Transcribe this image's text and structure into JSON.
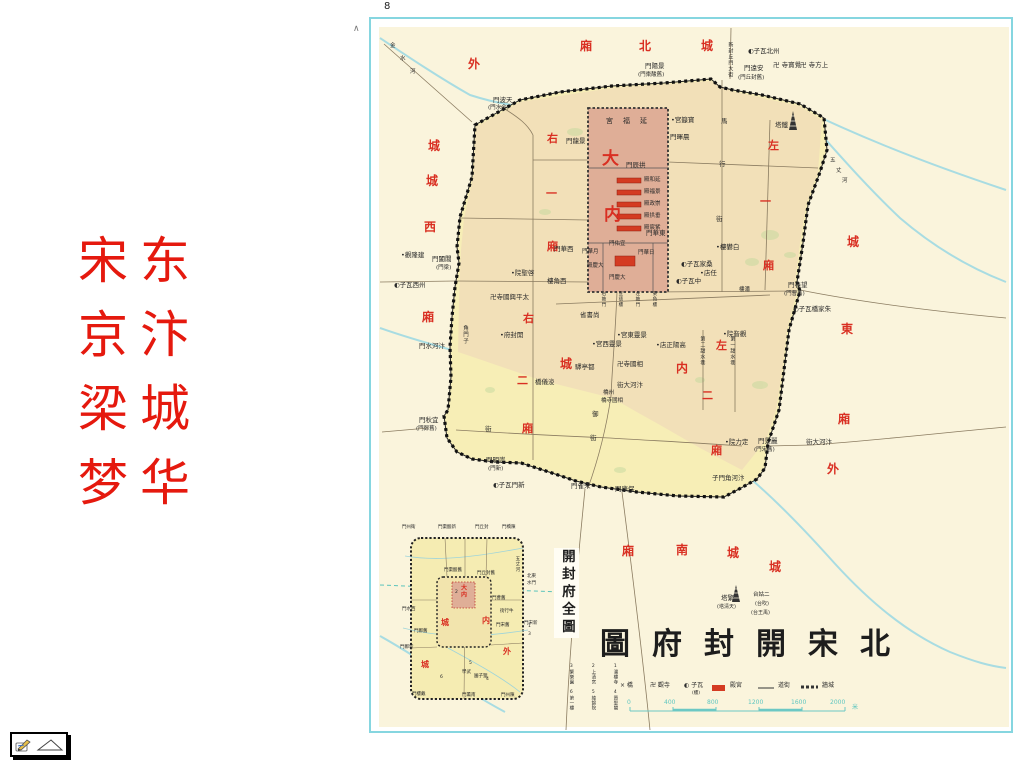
{
  "page": {
    "number": "8",
    "caret": "∧"
  },
  "slide_title": {
    "rows": [
      "宋东",
      "京汴",
      "梁城",
      "梦华"
    ],
    "color": "#e5190e"
  },
  "colors": {
    "slide_title_red": "#e5190e",
    "map_label_red": "#d92f22",
    "outer_paper": "#faf4dc",
    "city_fill": "#f7eeb6",
    "north_tint": "#f2e0b8",
    "palace_fill": "#dfae97",
    "hall_red": "#d43b22",
    "river_cyan": "#a8dce2",
    "frame_cyan": "#86d6e0",
    "scale_teal": "#5fc6c0"
  },
  "map": {
    "title": "圖府封開宋北",
    "inset_title": "開封府全圖",
    "legend": {
      "items": [
        {
          "sym": "×",
          "label": "橋",
          "x": 620
        },
        {
          "sym": "卍",
          "label": "觀寺",
          "x": 650
        },
        {
          "sym": "◐",
          "label": "子瓦",
          "x": 684,
          "sub": "(樓)"
        },
        {
          "sym": "rect",
          "label": "殿宮",
          "x": 730
        },
        {
          "sym": "line",
          "label": "道街",
          "x": 778
        },
        {
          "sym": "dash",
          "label": "牆城",
          "x": 822
        }
      ],
      "y": 683
    },
    "scale": {
      "ticks": [
        "0",
        "400",
        "800",
        "1200",
        "1600",
        "2000"
      ],
      "tick_x": [
        627,
        664,
        707,
        748,
        791,
        830
      ],
      "unit": "米",
      "unit_x": 852,
      "y": 700
    },
    "inset_legend": {
      "items": [
        "1潘樓寺",
        "2上清宮",
        "3繁樂園",
        "4資聖閣",
        "5綾錦院",
        "6第一樓"
      ],
      "col_x": [
        612,
        590,
        568
      ],
      "row_y": [
        664,
        690
      ]
    },
    "labels": [
      {
        "t": "外",
        "x": 468,
        "y": 58,
        "c": "red",
        "s": 12
      },
      {
        "t": "城",
        "x": 428,
        "y": 140,
        "c": "red",
        "s": 12
      },
      {
        "t": "城",
        "x": 426,
        "y": 175,
        "c": "red",
        "s": 12
      },
      {
        "t": "西",
        "x": 424,
        "y": 221,
        "c": "red",
        "s": 12
      },
      {
        "t": "廂",
        "x": 422,
        "y": 311,
        "c": "red",
        "s": 12
      },
      {
        "t": "廂",
        "x": 580,
        "y": 40,
        "c": "red",
        "s": 12
      },
      {
        "t": "北",
        "x": 639,
        "y": 40,
        "c": "red",
        "s": 12
      },
      {
        "t": "城",
        "x": 701,
        "y": 40,
        "c": "red",
        "s": 12
      },
      {
        "t": "右",
        "x": 547,
        "y": 133,
        "c": "red",
        "s": 11
      },
      {
        "t": "一",
        "x": 546,
        "y": 188,
        "c": "red",
        "s": 11
      },
      {
        "t": "廂",
        "x": 547,
        "y": 241,
        "c": "red",
        "s": 11
      },
      {
        "t": "左",
        "x": 768,
        "y": 140,
        "c": "red",
        "s": 11
      },
      {
        "t": "一",
        "x": 760,
        "y": 196,
        "c": "red",
        "s": 11
      },
      {
        "t": "廂",
        "x": 763,
        "y": 260,
        "c": "red",
        "s": 11
      },
      {
        "t": "大",
        "x": 602,
        "y": 150,
        "c": "red",
        "s": 17
      },
      {
        "t": "内",
        "x": 604,
        "y": 206,
        "c": "red",
        "s": 17
      },
      {
        "t": "右",
        "x": 523,
        "y": 313,
        "c": "red",
        "s": 11
      },
      {
        "t": "二",
        "x": 517,
        "y": 375,
        "c": "red",
        "s": 11
      },
      {
        "t": "廂",
        "x": 522,
        "y": 423,
        "c": "red",
        "s": 11
      },
      {
        "t": "内",
        "x": 676,
        "y": 362,
        "c": "red",
        "s": 12
      },
      {
        "t": "城",
        "x": 560,
        "y": 358,
        "c": "red",
        "s": 12
      },
      {
        "t": "左",
        "x": 716,
        "y": 340,
        "c": "red",
        "s": 11
      },
      {
        "t": "二",
        "x": 702,
        "y": 390,
        "c": "red",
        "s": 11
      },
      {
        "t": "廂",
        "x": 711,
        "y": 445,
        "c": "red",
        "s": 11
      },
      {
        "t": "城",
        "x": 847,
        "y": 236,
        "c": "red",
        "s": 12
      },
      {
        "t": "東",
        "x": 841,
        "y": 323,
        "c": "red",
        "s": 12
      },
      {
        "t": "廂",
        "x": 838,
        "y": 413,
        "c": "red",
        "s": 12
      },
      {
        "t": "外",
        "x": 827,
        "y": 463,
        "c": "red",
        "s": 12
      },
      {
        "t": "廂",
        "x": 622,
        "y": 545,
        "c": "red",
        "s": 12
      },
      {
        "t": "南",
        "x": 676,
        "y": 544,
        "c": "red",
        "s": 12
      },
      {
        "t": "城",
        "x": 727,
        "y": 547,
        "c": "red",
        "s": 12
      },
      {
        "t": "城",
        "x": 769,
        "y": 561,
        "c": "red",
        "s": 12
      },
      {
        "t": "門波天",
        "x": 493,
        "y": 97
      },
      {
        "t": "(門水金)",
        "x": 488,
        "y": 106,
        "s": 5.5
      },
      {
        "t": "門陽景",
        "x": 645,
        "y": 63
      },
      {
        "t": "(門棗酸舊)",
        "x": 638,
        "y": 73,
        "s": 5.5
      },
      {
        "t": "門遠安",
        "x": 744,
        "y": 65
      },
      {
        "t": "(門丘封舊)",
        "x": 738,
        "y": 76,
        "s": 5.5
      },
      {
        "t": "◐子瓦北州",
        "x": 748,
        "y": 48
      },
      {
        "t": "卍 寺寶覺",
        "x": 773,
        "y": 62
      },
      {
        "t": "卍 寺方上",
        "x": 800,
        "y": 62
      },
      {
        "t": "新封丘門大街",
        "x": 727,
        "y": 42,
        "v": 1,
        "s": 5
      },
      {
        "t": "塔鐵",
        "x": 775,
        "y": 122
      },
      {
        "t": "金",
        "x": 390,
        "y": 44,
        "s": 5.5
      },
      {
        "t": "水",
        "x": 400,
        "y": 57,
        "s": 5.5
      },
      {
        "t": "河",
        "x": 410,
        "y": 70,
        "s": 5.5
      },
      {
        "t": "五",
        "x": 830,
        "y": 159,
        "s": 5.5
      },
      {
        "t": "丈",
        "x": 836,
        "y": 169,
        "s": 5.5
      },
      {
        "t": "河",
        "x": 842,
        "y": 179,
        "s": 5.5
      },
      {
        "t": "宮福延",
        "x": 606,
        "y": 118,
        "s": 7,
        "ls": 10
      },
      {
        "t": "門龍景",
        "x": 566,
        "y": 138
      },
      {
        "t": "•宮籙寶",
        "x": 671,
        "y": 117
      },
      {
        "t": "門暉晨",
        "x": 670,
        "y": 134
      },
      {
        "t": "門辰拱",
        "x": 626,
        "y": 162
      },
      {
        "t": "殿和延",
        "x": 644,
        "y": 178,
        "s": 5.5
      },
      {
        "t": "殿福景",
        "x": 644,
        "y": 190,
        "s": 5.5
      },
      {
        "t": "殿政崇",
        "x": 644,
        "y": 202,
        "s": 5.5
      },
      {
        "t": "殿拱垂",
        "x": 644,
        "y": 214,
        "s": 5.5
      },
      {
        "t": "殿宸紫",
        "x": 644,
        "y": 226,
        "s": 5.5
      },
      {
        "t": "門華東",
        "x": 646,
        "y": 230
      },
      {
        "t": "門華西",
        "x": 554,
        "y": 246
      },
      {
        "t": "門佑宜",
        "x": 609,
        "y": 242,
        "s": 5.5
      },
      {
        "t": "門華月",
        "x": 582,
        "y": 250,
        "s": 5.5
      },
      {
        "t": "門華日",
        "x": 638,
        "y": 251,
        "s": 5.5
      },
      {
        "t": "殿慶大",
        "x": 587,
        "y": 264,
        "s": 5.5
      },
      {
        "t": "門慶大",
        "x": 609,
        "y": 276,
        "s": 5.5
      },
      {
        "t": "樓角西",
        "x": 547,
        "y": 278
      },
      {
        "t": "右掖門",
        "x": 600,
        "y": 291,
        "v": 1,
        "s": 4.5
      },
      {
        "t": "宣德樓",
        "x": 617,
        "y": 291,
        "v": 1,
        "s": 4.5
      },
      {
        "t": "左掖門",
        "x": 634,
        "y": 291,
        "v": 1,
        "s": 4.5
      },
      {
        "t": "東角樓",
        "x": 651,
        "y": 291,
        "v": 1,
        "s": 4.5
      },
      {
        "t": "•觀隆建",
        "x": 401,
        "y": 252
      },
      {
        "t": "門闔閶",
        "x": 432,
        "y": 256
      },
      {
        "t": "(門梁)",
        "x": 436,
        "y": 266,
        "s": 5.5
      },
      {
        "t": "◐子瓦西州",
        "x": 394,
        "y": 282
      },
      {
        "t": "•院聖啓",
        "x": 511,
        "y": 270
      },
      {
        "t": "卍寺國興平太",
        "x": 490,
        "y": 294
      },
      {
        "t": "角門子",
        "x": 461,
        "y": 325,
        "v": 1,
        "s": 5.5
      },
      {
        "t": "門水河汴",
        "x": 419,
        "y": 343
      },
      {
        "t": "門秋宜",
        "x": 419,
        "y": 417
      },
      {
        "t": "(門鄭舊)",
        "x": 416,
        "y": 427,
        "s": 5.5
      },
      {
        "t": "街",
        "x": 485,
        "y": 426
      },
      {
        "t": "門明崇",
        "x": 486,
        "y": 457
      },
      {
        "t": "(門新)",
        "x": 488,
        "y": 467,
        "s": 5.5
      },
      {
        "t": "◐子瓦門新",
        "x": 493,
        "y": 482
      },
      {
        "t": "門雀朱",
        "x": 571,
        "y": 483
      },
      {
        "t": "門康保",
        "x": 615,
        "y": 486
      },
      {
        "t": "子門角河汴",
        "x": 712,
        "y": 475
      },
      {
        "t": "•府封開",
        "x": 500,
        "y": 332
      },
      {
        "t": "省書尚",
        "x": 580,
        "y": 312
      },
      {
        "t": "•宮西靈景",
        "x": 592,
        "y": 341
      },
      {
        "t": "•宮東靈景",
        "x": 617,
        "y": 332
      },
      {
        "t": "驛亭都",
        "x": 575,
        "y": 364
      },
      {
        "t": "卍寺國相",
        "x": 617,
        "y": 361
      },
      {
        "t": "橋儀浚",
        "x": 535,
        "y": 379
      },
      {
        "t": "橋州",
        "x": 603,
        "y": 391,
        "s": 5.5
      },
      {
        "t": "橋寺國相",
        "x": 601,
        "y": 399,
        "s": 5.5
      },
      {
        "t": "街大河汴",
        "x": 617,
        "y": 382
      },
      {
        "t": "御",
        "x": 592,
        "y": 411
      },
      {
        "t": "街",
        "x": 590,
        "y": 435
      },
      {
        "t": "•店正陽高",
        "x": 656,
        "y": 342
      },
      {
        "t": "第二甜水巷",
        "x": 699,
        "y": 336,
        "v": 1,
        "s": 5
      },
      {
        "t": "第一甜水巷",
        "x": 729,
        "y": 336,
        "v": 1,
        "s": 5
      },
      {
        "t": "•院音觀",
        "x": 723,
        "y": 331
      },
      {
        "t": "•院力定",
        "x": 725,
        "y": 439
      },
      {
        "t": "門春望",
        "x": 788,
        "y": 282
      },
      {
        "t": "(門曹舊)",
        "x": 784,
        "y": 292,
        "s": 5.5
      },
      {
        "t": "門景麗",
        "x": 758,
        "y": 438
      },
      {
        "t": "(門宋舊)",
        "x": 754,
        "y": 448,
        "s": 5.5
      },
      {
        "t": "街大河汴",
        "x": 806,
        "y": 439
      },
      {
        "t": "◐子瓦橋家朱",
        "x": 793,
        "y": 306
      },
      {
        "t": "樓潘",
        "x": 739,
        "y": 288,
        "s": 5.5
      },
      {
        "t": "•樓礬白",
        "x": 716,
        "y": 244
      },
      {
        "t": "◐子瓦家桑",
        "x": 681,
        "y": 261
      },
      {
        "t": "◐子瓦中",
        "x": 676,
        "y": 278
      },
      {
        "t": "•店任",
        "x": 700,
        "y": 270
      },
      {
        "t": "馬",
        "x": 721,
        "y": 118
      },
      {
        "t": "行",
        "x": 719,
        "y": 161
      },
      {
        "t": "街",
        "x": 716,
        "y": 216
      },
      {
        "t": "塔繁",
        "x": 721,
        "y": 595
      },
      {
        "t": "(塔清天)",
        "x": 717,
        "y": 605,
        "s": 5
      },
      {
        "t": "台姑二",
        "x": 753,
        "y": 593,
        "s": 5.5
      },
      {
        "t": "(台吹)",
        "x": 755,
        "y": 602,
        "s": 5
      },
      {
        "t": "(台王禹)",
        "x": 751,
        "y": 611,
        "s": 5
      },
      {
        "t": "門州衛",
        "x": 402,
        "y": 526,
        "s": 4.5
      },
      {
        "t": "門棗酸新",
        "x": 438,
        "y": 526,
        "s": 4.5
      },
      {
        "t": "門丘封",
        "x": 475,
        "y": 526,
        "s": 4.5
      },
      {
        "t": "門橋陳",
        "x": 502,
        "y": 526,
        "s": 4.5
      },
      {
        "t": "門棗酸舊",
        "x": 444,
        "y": 569,
        "s": 4.5
      },
      {
        "t": "門丘封舊",
        "x": 477,
        "y": 572,
        "s": 4.5
      },
      {
        "t": "門水西",
        "x": 402,
        "y": 608,
        "s": 4.5
      },
      {
        "t": "門鄭舊",
        "x": 414,
        "y": 630,
        "s": 4.5
      },
      {
        "t": "門鄭新",
        "x": 400,
        "y": 646,
        "s": 4.5
      },
      {
        "t": "門曹舊",
        "x": 492,
        "y": 597,
        "s": 4.5
      },
      {
        "t": "街行牛",
        "x": 500,
        "y": 610,
        "s": 4.5
      },
      {
        "t": "門宋舊",
        "x": 496,
        "y": 624,
        "s": 4.5
      },
      {
        "t": "門宋新",
        "x": 524,
        "y": 622,
        "s": 4.5
      },
      {
        "t": "門樓戴",
        "x": 412,
        "y": 693,
        "s": 4.5
      },
      {
        "t": "門薰南",
        "x": 462,
        "y": 694,
        "s": 4.5
      },
      {
        "t": "門州陳",
        "x": 501,
        "y": 694,
        "s": 4.5
      },
      {
        "t": "學武",
        "x": 462,
        "y": 671,
        "s": 4.5
      },
      {
        "t": "園子狸",
        "x": 474,
        "y": 675,
        "s": 4.5
      },
      {
        "t": "五丈河",
        "x": 514,
        "y": 556,
        "v": 1,
        "s": 4.5
      },
      {
        "t": "北東",
        "x": 527,
        "y": 575,
        "s": 4.5
      },
      {
        "t": "水門",
        "x": 527,
        "y": 582,
        "s": 4.5
      },
      {
        "t": "1",
        "x": 528,
        "y": 625,
        "s": 4.5
      },
      {
        "t": "3",
        "x": 528,
        "y": 633,
        "s": 4.5
      },
      {
        "t": "2",
        "x": 455,
        "y": 591,
        "s": 4.5
      },
      {
        "t": "4",
        "x": 486,
        "y": 678,
        "s": 4.5
      },
      {
        "t": "5",
        "x": 469,
        "y": 662,
        "s": 4.5
      },
      {
        "t": "6",
        "x": 440,
        "y": 676,
        "s": 4.5
      },
      {
        "t": "大内",
        "x": 459,
        "y": 584,
        "v": 1,
        "c": "red",
        "s": 6
      },
      {
        "t": "城",
        "x": 441,
        "y": 619,
        "c": "red",
        "s": 8
      },
      {
        "t": "内",
        "x": 482,
        "y": 617,
        "c": "red",
        "s": 8
      },
      {
        "t": "城",
        "x": 421,
        "y": 661,
        "c": "red",
        "s": 8
      },
      {
        "t": "外",
        "x": 503,
        "y": 648,
        "c": "red",
        "s": 8
      }
    ]
  },
  "toolbar": {
    "pen_icon": "pen",
    "advance_icon": "triangle"
  }
}
